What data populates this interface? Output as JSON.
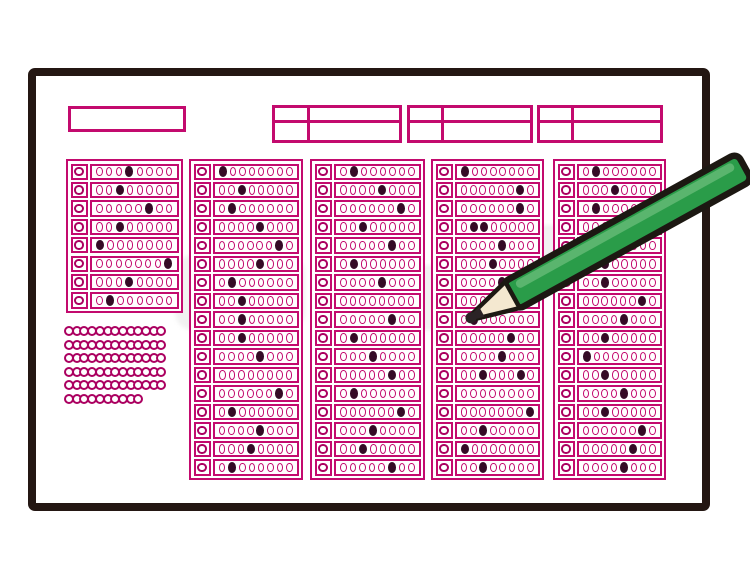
{
  "illustration": {
    "kind": "bubble-answer-sheet-with-pencil",
    "bubbles_per_row": 8
  },
  "colors": {
    "magenta": "#c30a6e",
    "magenta_bold": "#ab0060",
    "fill_dark": "#350b26",
    "sheet_ink": "#241713",
    "pencil_green": "#2a9c49",
    "pencil_green_light": "#5ab56e",
    "pencil_wood": "#f4e8d0",
    "pencil_tip": "#2b2326",
    "pencil_outline": "#1c1812"
  },
  "header": {
    "boxes": [
      {
        "name": "header-title-box",
        "divided": false
      },
      {
        "name": "header-field-box-1",
        "divided": true
      },
      {
        "name": "header-field-box-2",
        "divided": true
      },
      {
        "name": "header-field-box-3",
        "divided": true
      }
    ]
  },
  "answer_blocks": [
    {
      "name": "answer-block-1",
      "rows": 8,
      "filled_rows": [
        [
          4
        ],
        [
          3
        ],
        [
          6
        ],
        [
          3
        ],
        [
          1
        ],
        [
          8
        ],
        [
          4
        ],
        [
          2
        ]
      ]
    },
    {
      "name": "answer-block-2",
      "rows": 17,
      "filled_rows": [
        [
          1
        ],
        [
          3
        ],
        [
          2
        ],
        [
          5
        ],
        [
          7
        ],
        [
          5
        ],
        [
          2
        ],
        [
          3
        ],
        [
          3
        ],
        [
          3
        ],
        [
          5
        ],
        [],
        [
          7
        ],
        [
          2
        ],
        [
          5
        ],
        [
          4
        ],
        [
          2
        ]
      ]
    },
    {
      "name": "answer-block-3",
      "rows": 17,
      "filled_rows": [
        [
          2
        ],
        [
          5
        ],
        [
          7
        ],
        [
          3
        ],
        [
          6
        ],
        [
          2
        ],
        [
          5
        ],
        [],
        [
          6
        ],
        [
          2
        ],
        [
          4
        ],
        [
          6
        ],
        [
          2
        ],
        [
          7
        ],
        [
          4
        ],
        [
          3
        ],
        [
          6
        ]
      ]
    },
    {
      "name": "answer-block-4",
      "rows": 17,
      "filled_rows": [
        [
          1
        ],
        [
          7
        ],
        [
          7
        ],
        [
          2,
          3
        ],
        [
          5
        ],
        [
          4
        ],
        [
          5
        ],
        [],
        [
          2
        ],
        [
          6
        ],
        [
          5
        ],
        [
          3,
          7
        ],
        [],
        [
          8
        ],
        [
          3
        ],
        [
          1
        ],
        [
          3
        ]
      ]
    },
    {
      "name": "answer-block-5",
      "rows": 17,
      "filled_rows": [
        [
          2
        ],
        [
          4
        ],
        [
          2
        ],
        [],
        [
          5
        ],
        [
          3
        ],
        [
          3
        ],
        [
          7
        ],
        [
          5
        ],
        [
          3
        ],
        [
          1
        ],
        [
          3
        ],
        [
          5
        ],
        [
          3
        ],
        [
          7
        ],
        [
          6
        ],
        [
          5
        ]
      ]
    }
  ],
  "dot_cluster": {
    "row_lengths": [
      13,
      13,
      13,
      13,
      13,
      10
    ]
  },
  "pencil": {
    "tip_x": 467,
    "tip_y": 320,
    "angle_deg": -28.9
  }
}
